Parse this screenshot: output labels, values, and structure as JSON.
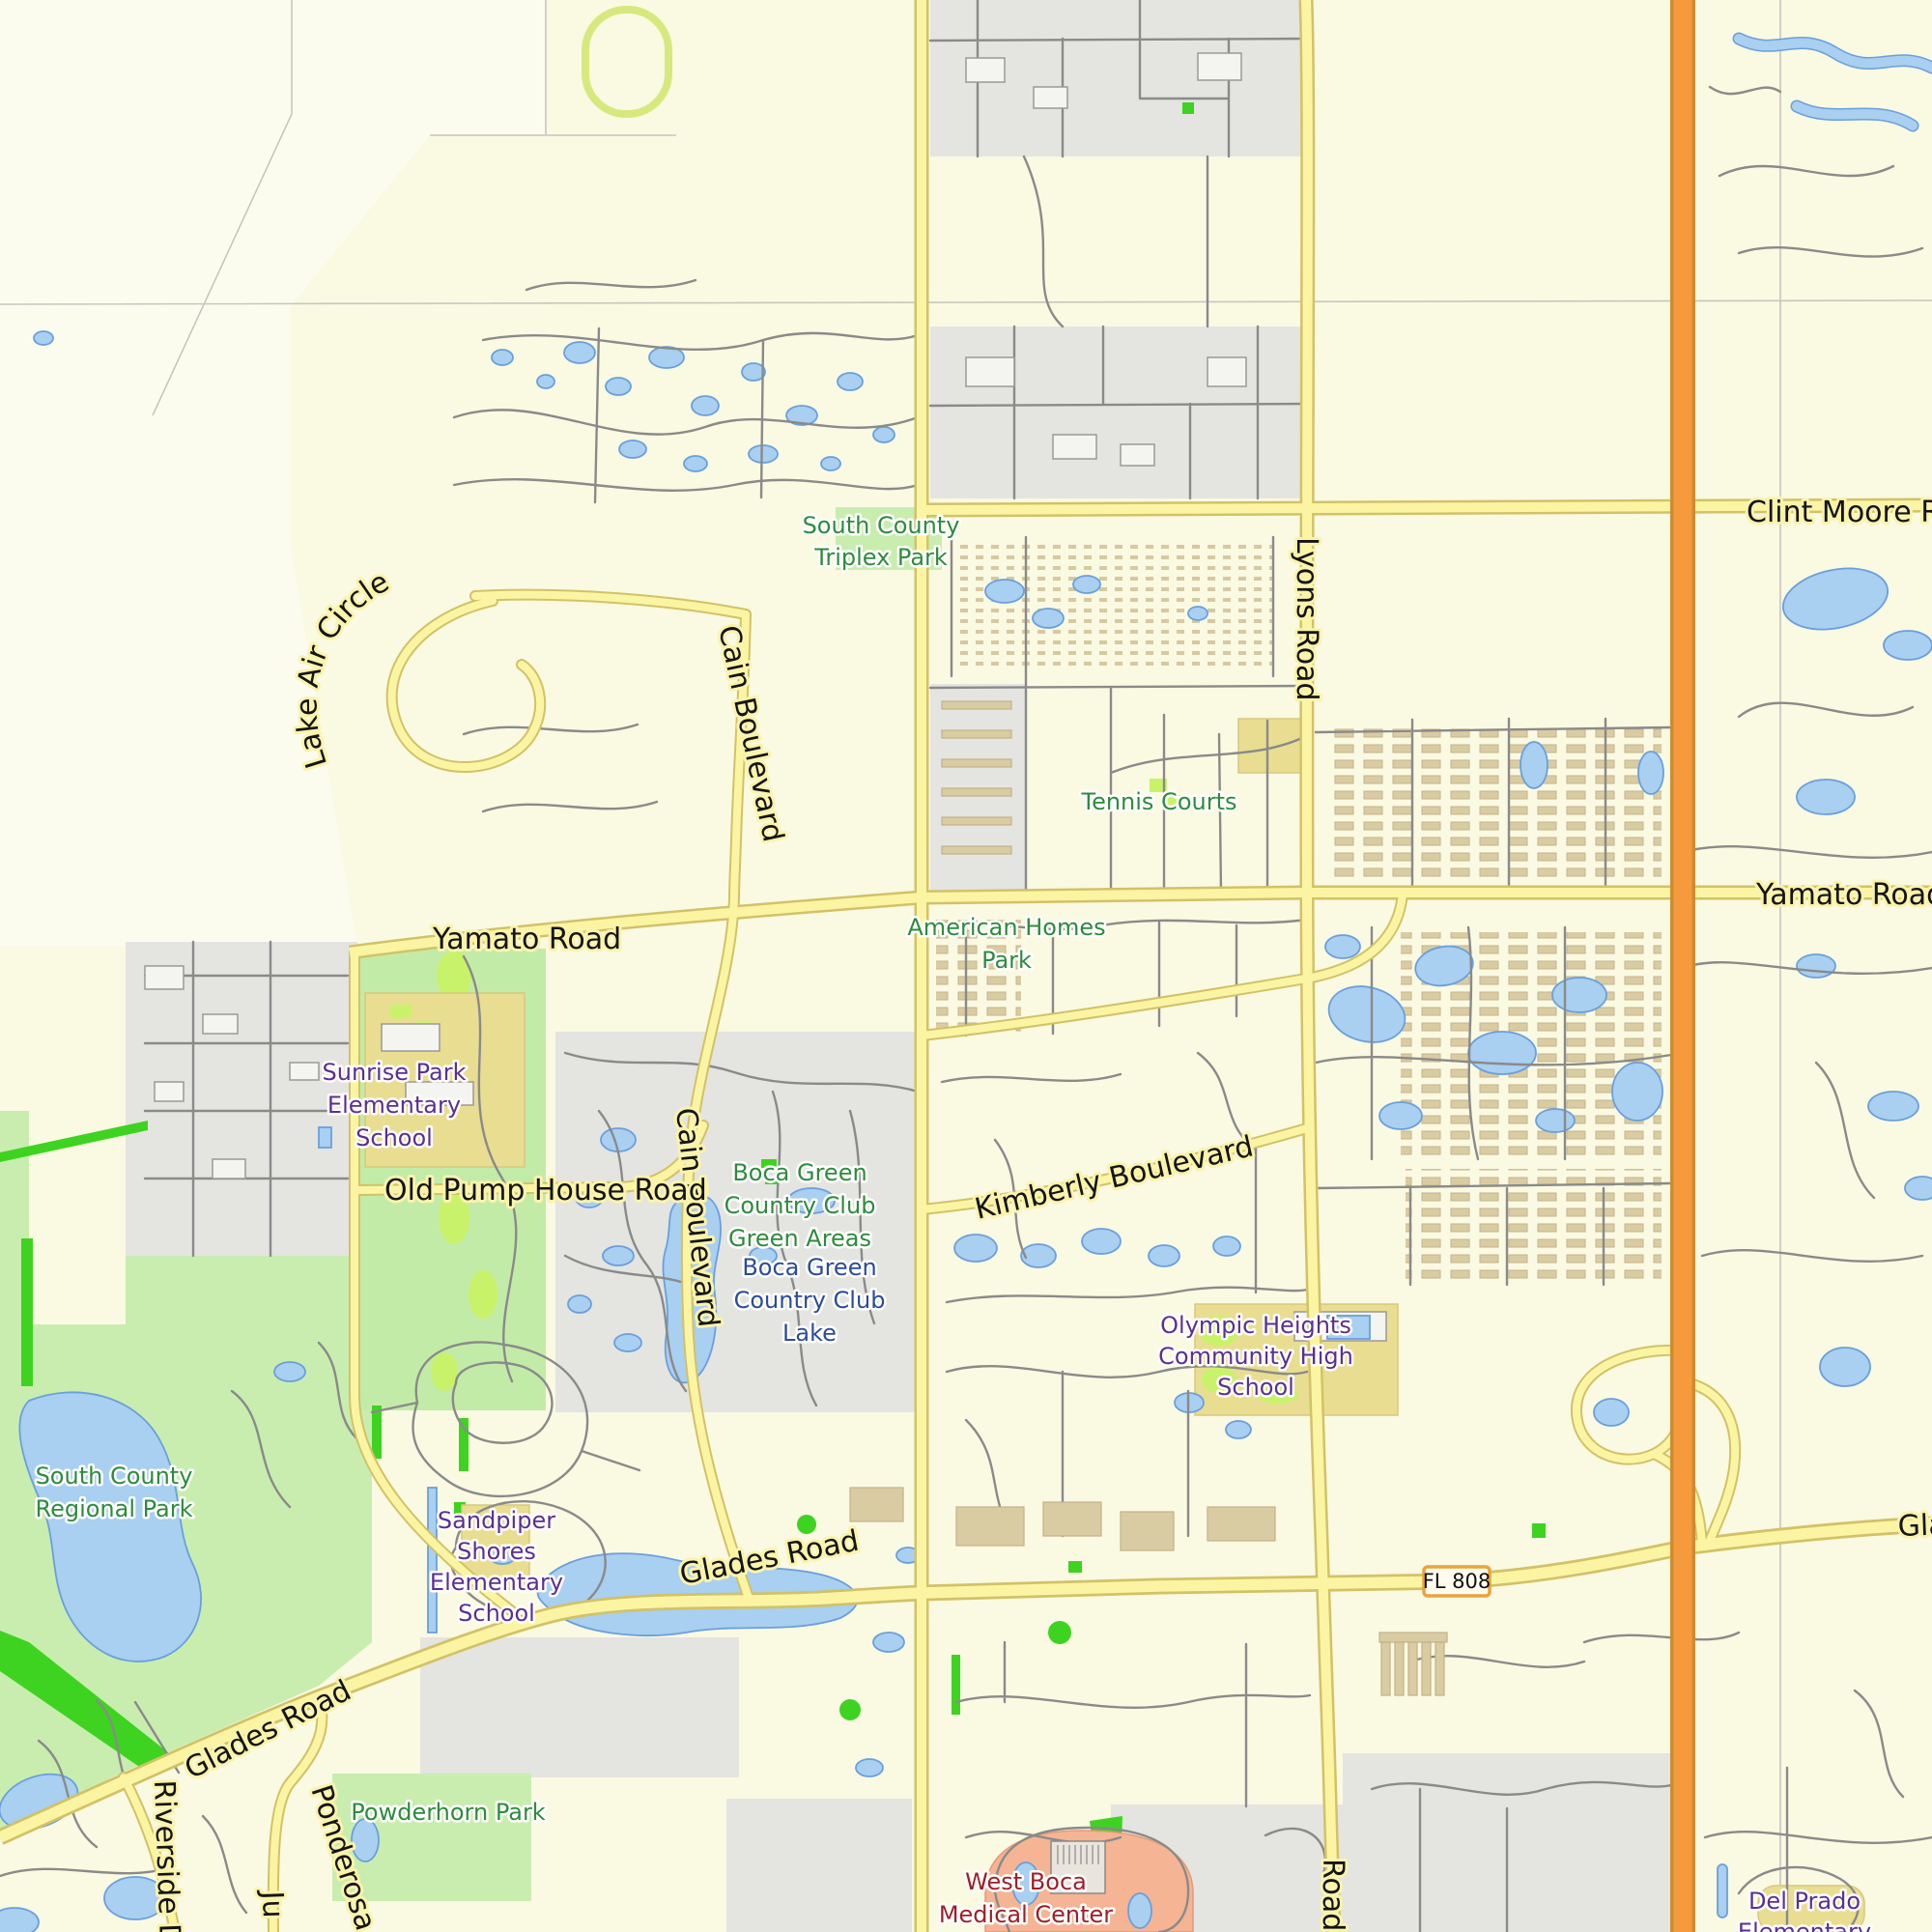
{
  "road_labels": {
    "clint_moore": "Clint Moore Road",
    "lyons_road": "Lyons Road",
    "lake_air_circle": "Lake Air Circle",
    "cain_boulevard_north": "Cain Boulevard",
    "cain_boulevard_south": "Cain Boulevard",
    "yamato_road_west": "Yamato Road",
    "yamato_road_east": "Yamato Road",
    "old_pump_house_road": "Old Pump House Road",
    "kimberly_boulevard": "Kimberly Boulevard",
    "glades_road_center": "Glades Road",
    "glades_road_west": "Glades Road",
    "glades_road_east": "Glades Road",
    "riverside": "Riverside Drive",
    "ponderosa": "Ponderosa",
    "ju": "Ju",
    "lyons_road_south": "Road"
  },
  "area_labels": {
    "south_county_triplex_park": [
      "South County",
      "Triplex Park"
    ],
    "tennis_courts": [
      "Tennis Courts"
    ],
    "american_homes_park": [
      "American Homes",
      "Park"
    ],
    "sunrise_park_school": [
      "Sunrise Park",
      "Elementary",
      "School"
    ],
    "boca_green_areas": [
      "Boca Green",
      "Country Club",
      "Green Areas"
    ],
    "boca_green_lake": [
      "Boca Green",
      "Country Club",
      "Lake"
    ],
    "olympic_heights": [
      "Olympic Heights",
      "Community High",
      "School"
    ],
    "south_county_regional_park": [
      "South County",
      "Regional Park"
    ],
    "sandpiper_shores": [
      "Sandpiper",
      "Shores",
      "Elementary",
      "School"
    ],
    "powderhorn_park": [
      "Powderhorn Park"
    ],
    "west_boca_medical": [
      "West Boca",
      "Medical Center"
    ],
    "del_prado": [
      "Del Prado",
      "Elementary"
    ]
  },
  "shields": {
    "fl_808": "FL 808"
  },
  "colors": {
    "background": "#FAF9E2",
    "road_yellow_fill": "#FBF5A3",
    "road_yellow_casing": "#D2C267",
    "highway_orange": "#F59B3D",
    "water_blue": "#A9CFF1",
    "park_green": "#C9EDAF",
    "vivid_green": "#3ED321",
    "residential_gray": "#E4E4E1",
    "school_khaki": "#E9DD92",
    "hospital_salmon": "#F5B493",
    "label_park_green": "#2E8B3C",
    "label_school_purple": "#5B2F91",
    "label_lake_blue": "#2B4B9B",
    "label_hospital_red": "#9E1F27"
  }
}
